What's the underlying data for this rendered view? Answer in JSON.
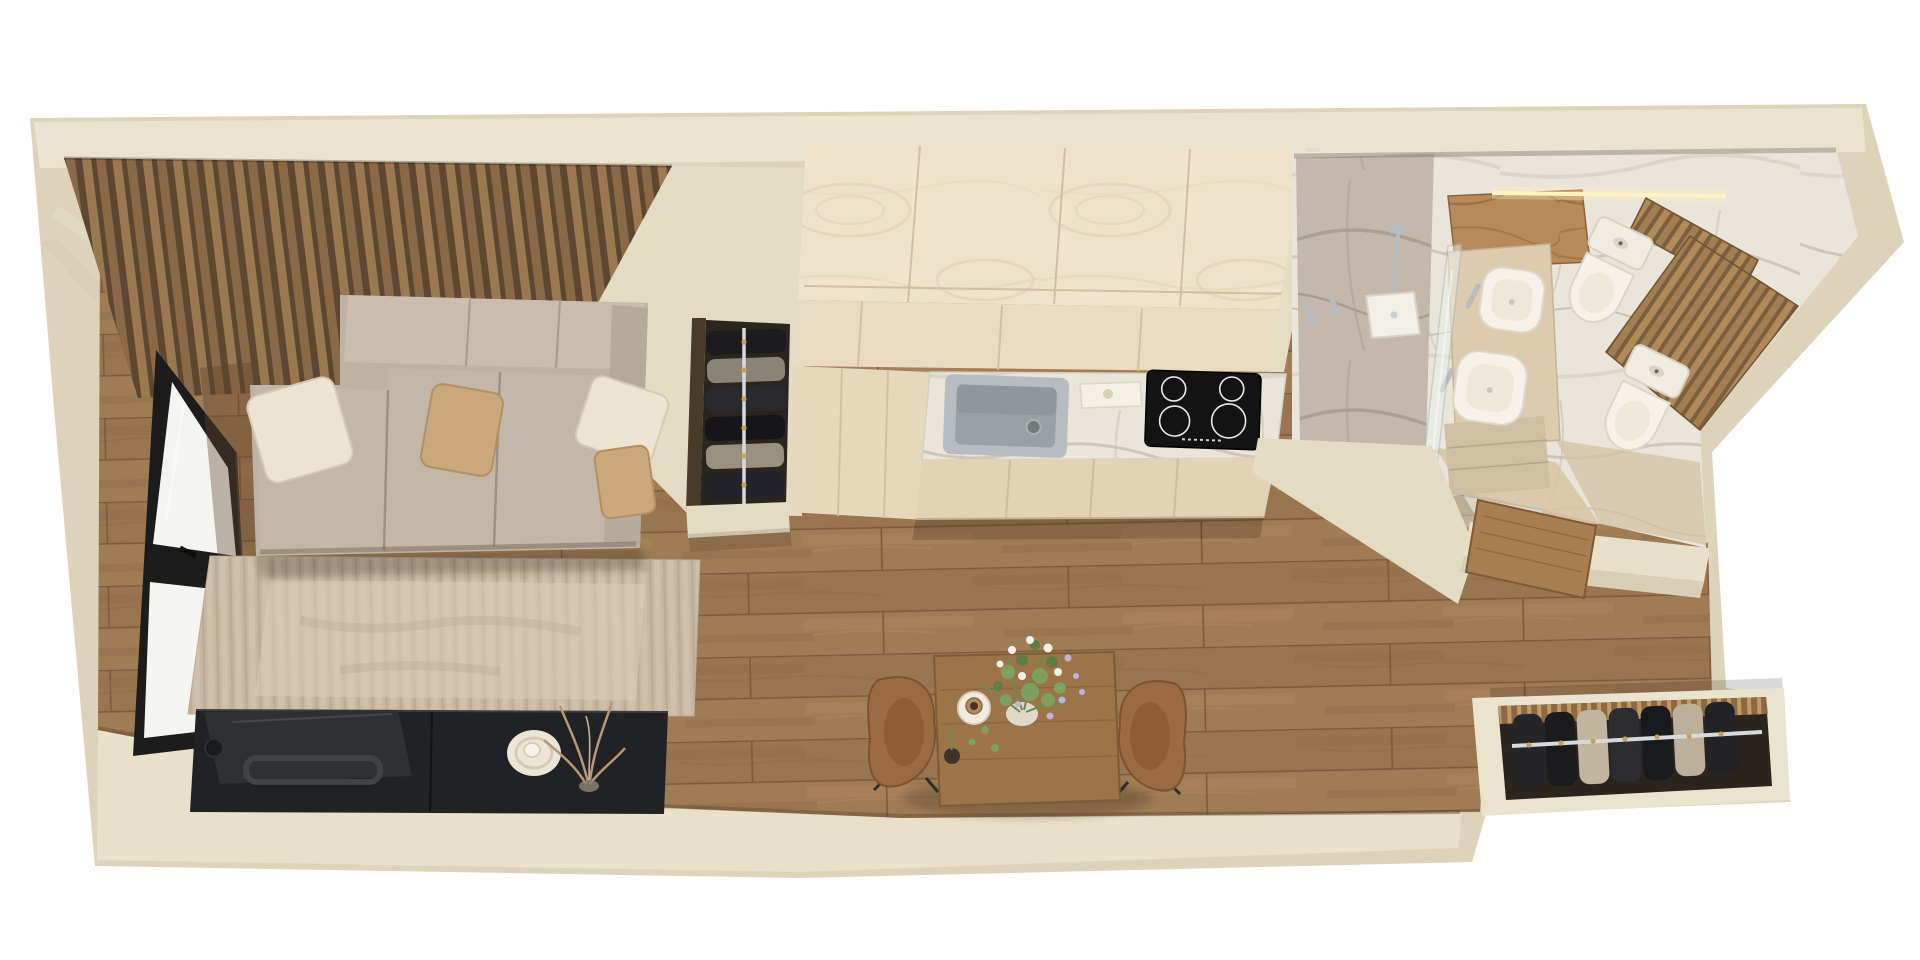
{
  "scene": {
    "kind": "3d-floor-plan-render",
    "view": "top-down axonometric",
    "apartment": "long narrow studio apartment",
    "rooms": [
      {
        "name": "living-room",
        "items": [
          "wood-slat-accent-wall",
          "corner-sofa",
          "sofa-pillows-x4",
          "area-rug",
          "tv-console",
          "tv-panel",
          "balcony-window",
          "dried-twigs",
          "round-tray"
        ]
      },
      {
        "name": "wardrobe-nook",
        "items": [
          "open-wardrobe",
          "clothes-rail",
          "hanging-clothes"
        ]
      },
      {
        "name": "kitchen",
        "items": [
          "tall-ash-cabinets",
          "marble-countertop",
          "steel-sink",
          "induction-cooktop-4-burners",
          "small-tray"
        ]
      },
      {
        "name": "bathroom",
        "items": [
          "walk-in-shower",
          "rain-shower-head",
          "glass-partition",
          "vessel-basin-x2",
          "toilet-x2",
          "led-lit-oak-vanity",
          "wood-slat-walls",
          "wooden-door",
          "beige-tile-floor"
        ]
      },
      {
        "name": "hallway",
        "items": [
          "oak-plank-floor",
          "dining-table",
          "leather-chair-x2",
          "flower-vase",
          "dinner-plate",
          "entry-closet-with-rail"
        ]
      }
    ],
    "counts": {
      "pillows": 4,
      "toilets": 2,
      "basins": 2,
      "chairs": 2,
      "cooktop_burners": 4
    }
  },
  "palette": {
    "background": "#ffffff",
    "wall_side": "#ddd3bb",
    "wall_top": "#eae3d0",
    "wall_bottom_inner": "#e8e0ca",
    "wall_face": "#e4dbc4",
    "wall_outer": "#d9cfb6",
    "floor_wood": "#a07c54",
    "floor_seam": "#7a5b3c",
    "accent_slat": "#9a7850",
    "accent_slat_gap": "#5d4730",
    "sofa_body": "#bdb2a3",
    "sofa_back": "#c8bdaf",
    "sofa_seat": "#c2b7a8",
    "sofa_arm": "#b5aa9b",
    "pillow_cream": "#ece3d2",
    "pillow_tan": "#c9a87c",
    "rug_light": "#dbcdb9",
    "tv_console": "#212225",
    "tv_panel": "#2e3033",
    "window_frame": "#1c1c1c",
    "glass_daylight": "#f4f4f1",
    "kitchen_band_mid": "#e8dbc2",
    "kitchen_front": "#e6d8bd",
    "kitchen_front_lower": "#e2d3b6",
    "kitchen_edge": "#e5dcc4",
    "sink_steel": "#9aa0a3",
    "cooktop_black": "#131313",
    "shower_glass": "#e8f0ef",
    "fixture_white": "#f6f2e9",
    "chrome": "#b6bcc0",
    "wood_oak": "#b8895a",
    "door_wood": "#a97f52",
    "led_glow": "#ffefb8",
    "tile_beige": "#d8c5a6",
    "table_wood": "#9c7448",
    "chair_leather": "#9b6a42",
    "closet_interior": "#2a251f",
    "clothes_dark": "#26262a",
    "clothes_tan": "#c3b6a0",
    "rail_chrome": "#d6dadd",
    "greenery": "#7da05e",
    "flower_white": "#f3f0e7",
    "flower_lavender": "#bfb3d6"
  }
}
